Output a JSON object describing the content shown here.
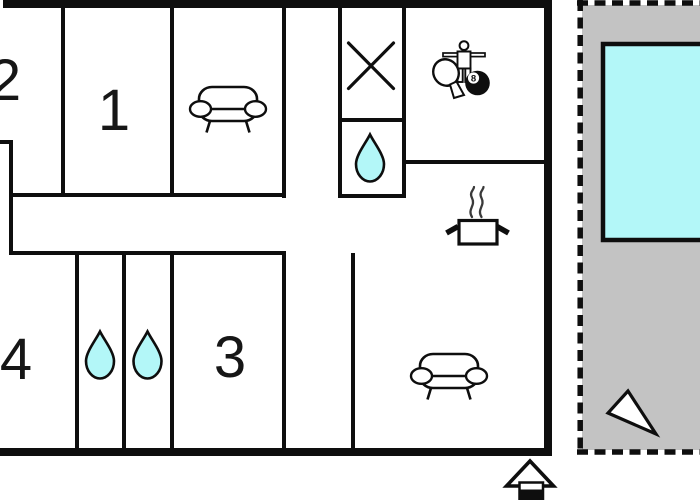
{
  "rooms": {
    "room1": {
      "label": "1"
    },
    "room2": {
      "label": "2"
    },
    "room3": {
      "label": "3"
    },
    "room4": {
      "label": "4"
    }
  },
  "billiard_ball": {
    "number": "8"
  },
  "colors": {
    "ink": "#0e0e0e",
    "water": "#b3f7f8",
    "pool": "#b3f7f8",
    "terrace_gray": "#c3c3c3",
    "background": "#ffffff"
  },
  "icons": {
    "sofa-icon": "two-seat sofa outline",
    "cross-icon": "X marker (stairs/void)",
    "water-drop-icon": "teardrop (bath/shower)",
    "table-tennis-paddle-icon": "ping-pong paddle",
    "foosball-player-icon": "table-football figure",
    "eight-ball-icon": "billiard 8-ball",
    "cooking-pot-icon": "steaming pot (kitchen)",
    "swimming-pool-icon": "pool basin",
    "direction-triangle-icon": "triangle pointer",
    "house-icon": "house marker"
  }
}
